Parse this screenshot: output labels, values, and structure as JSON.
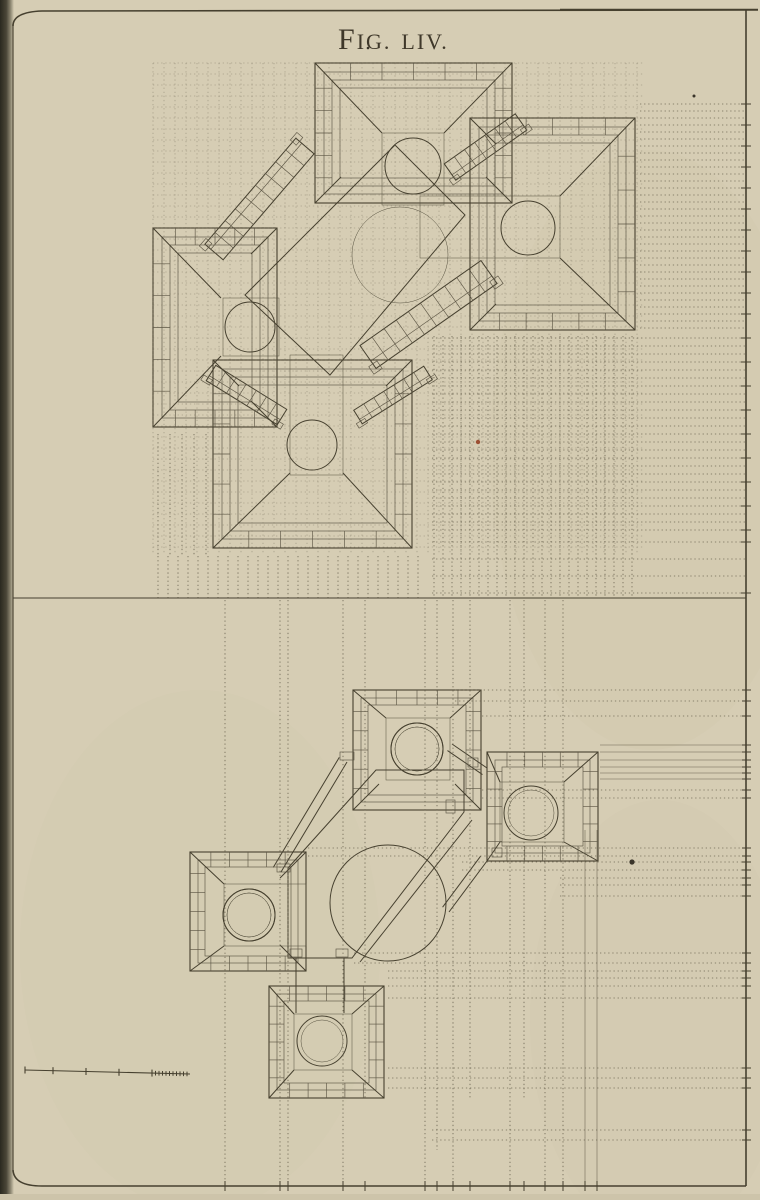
{
  "title": {
    "full": "Fig. LIV.",
    "parts": [
      "F",
      "IG.",
      "LIV."
    ]
  },
  "colors": {
    "paper": "#d6cdb4",
    "paper_shade": "#cdc4aa",
    "binding_dark": "#2a291f",
    "ink": "#46402f",
    "ink_soft": "#5d5645",
    "dot_line": "#6b6450",
    "hatch_base": "#a69d84",
    "hatch_line": "#5c5544",
    "hatch_mid_base": "#b0a78d",
    "hatch_mid_line": "#6e6653",
    "hatch_dark_base": "#989075",
    "hatch_dark_line": "#524b3b",
    "speck_red": "#9c4f33",
    "speck_dark": "#3a352a"
  },
  "plate": {
    "left": 13,
    "top": 11,
    "right": 746,
    "bottom": 1186,
    "divider_y": 598
  },
  "upper": {
    "towers": [
      {
        "x": 315,
        "y": 63,
        "w": 197,
        "h": 140,
        "open": "S",
        "insets": [
          9,
          17,
          25
        ],
        "inner": [
          382,
          133,
          62,
          70
        ]
      },
      {
        "x": 470,
        "y": 118,
        "w": 165,
        "h": 212,
        "open": "W",
        "insets": [
          9,
          17,
          25
        ],
        "inner": [
          470,
          196,
          90,
          62
        ]
      },
      {
        "x": 153,
        "y": 228,
        "w": 124,
        "h": 199,
        "open": "E",
        "insets": [
          9,
          17,
          25
        ],
        "inner": [
          221,
          298,
          56,
          58
        ]
      },
      {
        "x": 213,
        "y": 360,
        "w": 199,
        "h": 188,
        "open": "N",
        "insets": [
          9,
          17,
          25
        ],
        "inner": [
          290,
          360,
          53,
          113
        ]
      }
    ],
    "gallery": {
      "rects": [
        [
          382,
          133,
          62,
          72
        ],
        [
          420,
          196,
          140,
          62
        ],
        [
          223,
          298,
          56,
          58
        ],
        [
          290,
          355,
          53,
          120
        ]
      ],
      "poly": [
        [
          395,
          145
        ],
        [
          465,
          215
        ],
        [
          330,
          375
        ],
        [
          245,
          295
        ]
      ],
      "big_circle": [
        400,
        255,
        48
      ],
      "circles": [
        [
          413,
          166,
          28
        ],
        [
          528,
          228,
          27
        ],
        [
          250,
          327,
          25
        ],
        [
          312,
          445,
          25
        ]
      ]
    },
    "ramps": [
      {
        "x1": 305,
        "y1": 146,
        "x2": 214,
        "y2": 252,
        "w": 24,
        "rungs": 8
      },
      {
        "x1": 450,
        "y1": 172,
        "x2": 521,
        "y2": 122,
        "w": 20,
        "rungs": 6
      },
      {
        "x1": 368,
        "y1": 357,
        "x2": 489,
        "y2": 272,
        "w": 28,
        "rungs": 9
      },
      {
        "x1": 211,
        "y1": 373,
        "x2": 282,
        "y2": 417,
        "w": 18,
        "rungs": 6
      },
      {
        "x1": 358,
        "y1": 417,
        "x2": 428,
        "y2": 373,
        "w": 16,
        "rungs": 6
      }
    ],
    "construction": {
      "h_blocks": [
        {
          "y0": 104,
          "y1": 334,
          "step": 7,
          "x1": 640,
          "x2": 746
        },
        {
          "y0": 338,
          "y1": 530,
          "step": 8,
          "x1": 432,
          "x2": 746
        },
        {
          "y0": 542,
          "y1": 594,
          "step": 17,
          "x1": 432,
          "x2": 746
        }
      ],
      "v_blocks": [
        {
          "x0": 434,
          "x1": 640,
          "step": 9,
          "y0": 336,
          "y1": 598
        },
        {
          "x0": 158,
          "x1": 426,
          "step": 10,
          "y0": 556,
          "y1": 598
        },
        {
          "x0": 158,
          "x1": 212,
          "step": 12,
          "y0": 434,
          "y1": 556
        }
      ],
      "grid": {
        "x": 153,
        "y": 63,
        "w": 490,
        "h": 492,
        "step": 11
      }
    }
  },
  "lower": {
    "towers": [
      {
        "x": 353,
        "y": 690,
        "w": 128,
        "h": 120,
        "open": "S",
        "insets": [
          8,
          15
        ],
        "inner": [
          386,
          718,
          64,
          62
        ],
        "ring": [
          417,
          749,
          26,
          22
        ]
      },
      {
        "x": 487,
        "y": 752,
        "w": 111,
        "h": 109,
        "open": null,
        "insets": [
          8,
          15
        ],
        "inner": [
          500,
          782,
          64,
          60
        ],
        "ring": [
          531,
          813,
          27,
          23
        ]
      },
      {
        "x": 190,
        "y": 852,
        "w": 116,
        "h": 119,
        "open": "E",
        "insets": [
          8,
          15
        ],
        "inner": [
          224,
          884,
          82,
          62
        ],
        "ring": [
          249,
          915,
          26,
          22
        ]
      },
      {
        "x": 269,
        "y": 986,
        "w": 115,
        "h": 112,
        "open": null,
        "insets": [
          8,
          15
        ],
        "inner": [
          294,
          1014,
          58,
          56
        ],
        "ring": [
          322,
          1041,
          25,
          21
        ]
      }
    ],
    "gallery": {
      "hex": [
        [
          376,
          770
        ],
        [
          464,
          770
        ],
        [
          464,
          812
        ],
        [
          352,
          958
        ],
        [
          288,
          958
        ],
        [
          288,
          868
        ]
      ],
      "big_circle": [
        388,
        903,
        58
      ]
    },
    "walls": [
      {
        "x1": 347,
        "y1": 762,
        "x2": 281,
        "y2": 872,
        "off": 9
      },
      {
        "x1": 452,
        "y1": 744,
        "x2": 487,
        "y2": 768,
        "off": 8
      },
      {
        "x1": 487,
        "y1": 861,
        "x2": 449,
        "y2": 912,
        "off": 8
      },
      {
        "x1": 296,
        "y1": 958,
        "x2": 296,
        "y2": 1013,
        "off": 0
      },
      {
        "x1": 344,
        "y1": 958,
        "x2": 344,
        "y2": 1013,
        "off": 0
      },
      {
        "x1": 472,
        "y1": 820,
        "x2": 360,
        "y2": 962,
        "off": 0
      }
    ],
    "blocks": [
      [
        340,
        752,
        14,
        8
      ],
      [
        277,
        864,
        13,
        8
      ],
      [
        446,
        800,
        9,
        13
      ],
      [
        290,
        949,
        12,
        8
      ],
      [
        336,
        949,
        12,
        8
      ],
      [
        468,
        758,
        10,
        9
      ],
      [
        492,
        848,
        10,
        9
      ]
    ],
    "construction": {
      "v_lines": [
        {
          "x": 225,
          "y0": 600,
          "y1": 1186
        },
        {
          "x": 280,
          "y0": 600,
          "y1": 1186
        },
        {
          "x": 288,
          "y0": 600,
          "y1": 1186
        },
        {
          "x": 343,
          "y0": 600,
          "y1": 1186
        },
        {
          "x": 365,
          "y0": 600,
          "y1": 1100
        },
        {
          "x": 425,
          "y0": 600,
          "y1": 1186
        },
        {
          "x": 437,
          "y0": 600,
          "y1": 1150
        },
        {
          "x": 453,
          "y0": 600,
          "y1": 1186
        },
        {
          "x": 470,
          "y0": 600,
          "y1": 1100
        },
        {
          "x": 510,
          "y0": 600,
          "y1": 1186
        },
        {
          "x": 524,
          "y0": 600,
          "y1": 1100
        },
        {
          "x": 545,
          "y0": 600,
          "y1": 1186
        },
        {
          "x": 563,
          "y0": 600,
          "y1": 1186
        },
        {
          "x": 585,
          "y0": 830,
          "y1": 1186,
          "s": 1
        },
        {
          "x": 597,
          "y0": 830,
          "y1": 1186,
          "s": 1
        }
      ],
      "h_lines": [
        {
          "y": 690,
          "x1": 455
        },
        {
          "y": 701,
          "x1": 455
        },
        {
          "y": 716,
          "x1": 482
        },
        {
          "y": 745,
          "x1": 600,
          "s": 1
        },
        {
          "y": 752,
          "x1": 600,
          "s": 1
        },
        {
          "y": 760,
          "x1": 600,
          "s": 1
        },
        {
          "y": 767,
          "x1": 600,
          "s": 1
        },
        {
          "y": 773,
          "x1": 600,
          "s": 1
        },
        {
          "y": 779,
          "x1": 600,
          "s": 1
        },
        {
          "y": 790,
          "x1": 482
        },
        {
          "y": 798,
          "x1": 482
        },
        {
          "y": 848,
          "x1": 308
        },
        {
          "y": 856,
          "x1": 308
        },
        {
          "y": 862,
          "x1": 462
        },
        {
          "y": 870,
          "x1": 462
        },
        {
          "y": 878,
          "x1": 560
        },
        {
          "y": 885,
          "x1": 560
        },
        {
          "y": 896,
          "x1": 560
        },
        {
          "y": 953,
          "x1": 354
        },
        {
          "y": 963,
          "x1": 354
        },
        {
          "y": 971,
          "x1": 388
        },
        {
          "y": 978,
          "x1": 388
        },
        {
          "y": 986,
          "x1": 388
        },
        {
          "y": 998,
          "x1": 388
        },
        {
          "y": 1068,
          "x1": 388
        },
        {
          "y": 1078,
          "x1": 388
        },
        {
          "y": 1088,
          "x1": 388
        },
        {
          "y": 1130,
          "x1": 432
        },
        {
          "y": 1140,
          "x1": 432
        }
      ]
    }
  },
  "scale_bar": {
    "x1": 25,
    "y1": 1070,
    "x2": 190,
    "y2": 1074,
    "majors": [
      25,
      53,
      86,
      119,
      152
    ],
    "minor_start": 152,
    "minor_end": 190,
    "minor_step": 3.5,
    "tick_h": 7
  },
  "specks": [
    {
      "x": 478,
      "y": 442,
      "r": 2.2,
      "c": "speck_red"
    },
    {
      "x": 632,
      "y": 862,
      "r": 2.6,
      "c": "speck_dark"
    },
    {
      "x": 694,
      "y": 96,
      "r": 1.5,
      "c": "speck_dark"
    },
    {
      "x": 368,
      "y": 48,
      "r": 1.3,
      "c": "speck_dark"
    }
  ]
}
